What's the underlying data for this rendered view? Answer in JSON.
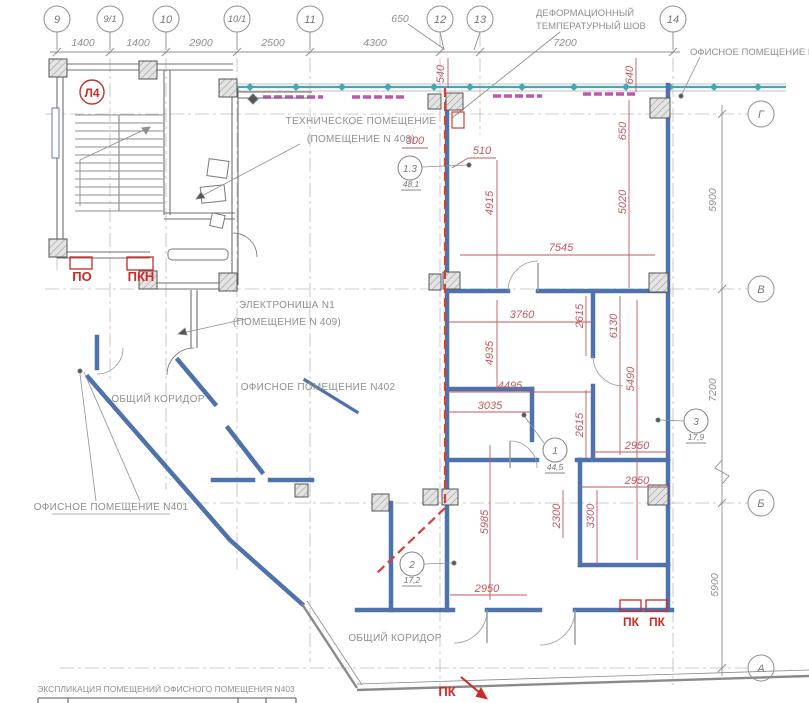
{
  "drawing": {
    "axes_top": [
      {
        "label": "9"
      },
      {
        "label": "9/1"
      },
      {
        "label": "10"
      },
      {
        "label": "10/1"
      },
      {
        "label": "11"
      },
      {
        "label": "12"
      },
      {
        "label": "13"
      },
      {
        "label": "14"
      }
    ],
    "axes_right": [
      {
        "label": "Г"
      },
      {
        "label": "В"
      },
      {
        "label": "Б"
      },
      {
        "label": "А"
      }
    ],
    "dims_top": [
      "1400",
      "1400",
      "2900",
      "2500",
      "4300",
      "650",
      "7200"
    ],
    "dims_right": [
      "5900",
      "7200",
      "5900"
    ],
    "joint_note": [
      "ДЕФОРМАЦИОННЫЙ",
      "ТЕМПЕРАТУРНЫЙ ШОВ"
    ],
    "room_labels": {
      "n404": "ОФИСНОЕ ПОМЕЩЕНИЕ N404",
      "tech_line1": "ТЕХНИЧЕСКОЕ ПОМЕЩЕНИЕ",
      "tech_line2": "(ПОМЕЩЕНИЕ N 408)",
      "niche_line1": "ЭЛЕКТРОНИША N1",
      "niche_line2": "(ПОМЕЩЕНИЕ N 409)",
      "n402": "ОФИСНОЕ ПОМЕЩЕНИЕ N402",
      "n401": "ОФИСНОЕ ПОМЕЩЕНИЕ N401",
      "corridor_left": "ОБЩИЙ КОРИДОР",
      "corridor_bottom": "ОБЩИЙ КОРИДОР"
    },
    "red_marks": {
      "stair": "Л4",
      "po": "ПО",
      "pkn": "ПКН",
      "pk_a": "ПК",
      "pk_b": "ПК",
      "pk_c": "ПК"
    },
    "area_tags": [
      {
        "num": "1.3",
        "area": "48,1"
      },
      {
        "num": "1",
        "area": "44,5"
      },
      {
        "num": "2",
        "area": "17,2"
      },
      {
        "num": "3",
        "area": "17,9"
      }
    ],
    "red_dims": [
      "300",
      "510",
      "540",
      "640",
      "650",
      "4915",
      "5020",
      "7545",
      "3760",
      "2615",
      "6130",
      "4935",
      "5490",
      "4495",
      "3035",
      "2615",
      "2950",
      "2950",
      "2300",
      "3300",
      "5985",
      "2950"
    ],
    "table_title": "ЭКСПЛИКАЦИЯ ПОМЕЩЕНИЙ ОФИСНОГО ПОМЕЩЕНИЯ N403",
    "colors": {
      "wall_blue": "#4e72ab",
      "wall_gray": "#6f6f6f",
      "dim_red": "#c05a60",
      "marker_red": "#cc2a24",
      "facade_cyan": "#43a8b1",
      "facade_magenta": "#bf57ad",
      "line_gray": "#8f8f8f"
    }
  }
}
